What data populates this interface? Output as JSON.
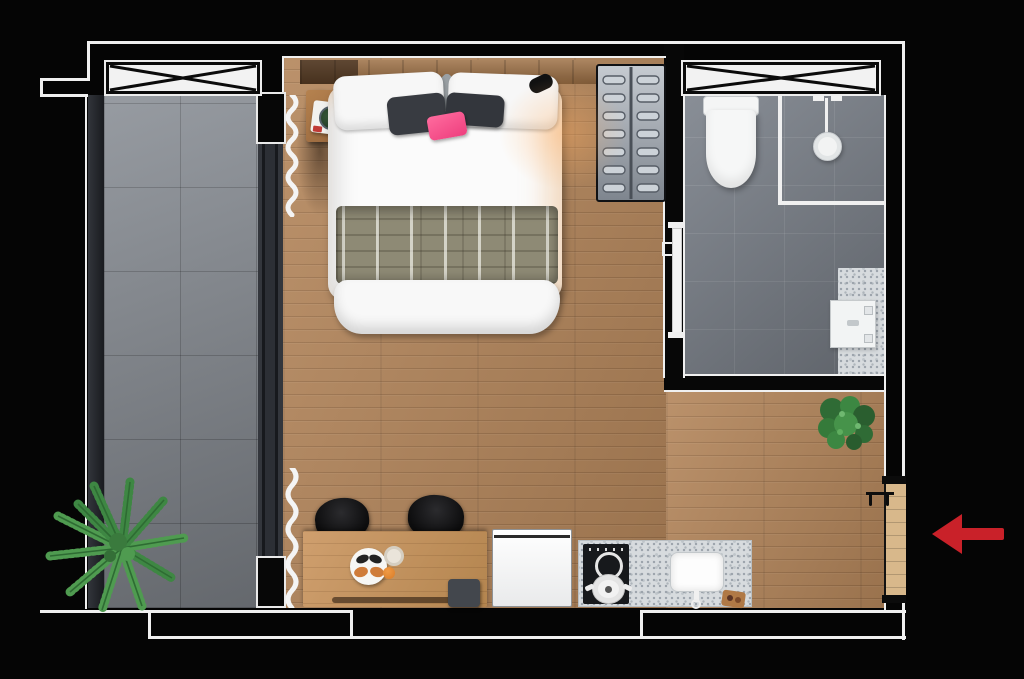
{
  "scene": {
    "title": "studio-apartment-floor-plan",
    "view": "top-down-3d-render",
    "canvas": {
      "width": 1024,
      "height": 679
    }
  },
  "palette": {
    "background": "#050505",
    "wall_line": "#f0f0f0",
    "wood_floor": "#b3855a",
    "balcony_tile": "#8b9097",
    "bathroom_tile": "#7d838c",
    "terrazzo_counter": "#d7dbde",
    "wardrobe_gray": "#9aa0a7",
    "appliance_white": "#f5f5f5",
    "chair_black": "#121212",
    "accent_pink_pillow": "#ee3f7e",
    "plant_green": "#4f9b50",
    "bush_green": "#2f6b35",
    "entry_door_wood": "#d8b88b",
    "arrow_red": "#c92129"
  },
  "rooms": [
    {
      "name": "balcony",
      "floor": "gray-tile"
    },
    {
      "name": "living-sleeping-area",
      "floor": "oak-wood"
    },
    {
      "name": "bathroom",
      "floor": "dark-gray-tile"
    },
    {
      "name": "kitchenette",
      "floor": "oak-wood"
    },
    {
      "name": "entrance",
      "floor": "oak-wood"
    }
  ],
  "windows": [
    {
      "name": "balcony-window",
      "symbol": "x-brace"
    },
    {
      "name": "bathroom-window",
      "symbol": "x-brace"
    }
  ],
  "fixtures": [
    "double-bed",
    "white-pillows",
    "dark-pillows",
    "pink-accent-pillow",
    "patterned-throw-blanket",
    "headboard-shelf",
    "nightstand",
    "book-with-plant",
    "wall-lamp",
    "louvered-wardrobe",
    "toilet",
    "walk-in-shower",
    "shower-head",
    "glass-partition",
    "bathroom-vanity-sink",
    "bathroom-door",
    "sliding-glass-door",
    "sheer-curtains",
    "palm-plant",
    "potted-bush",
    "desk-dining-table",
    "two-black-chairs",
    "breakfast-plate",
    "refrigerator",
    "terrazzo-kitchen-counter",
    "cooktop-with-pot",
    "kitchen-sink",
    "cutting-board",
    "entry-door",
    "coat-hooks"
  ],
  "annotation": {
    "type": "arrow",
    "direction": "left",
    "target": "entry-door",
    "color": "#c92129"
  }
}
